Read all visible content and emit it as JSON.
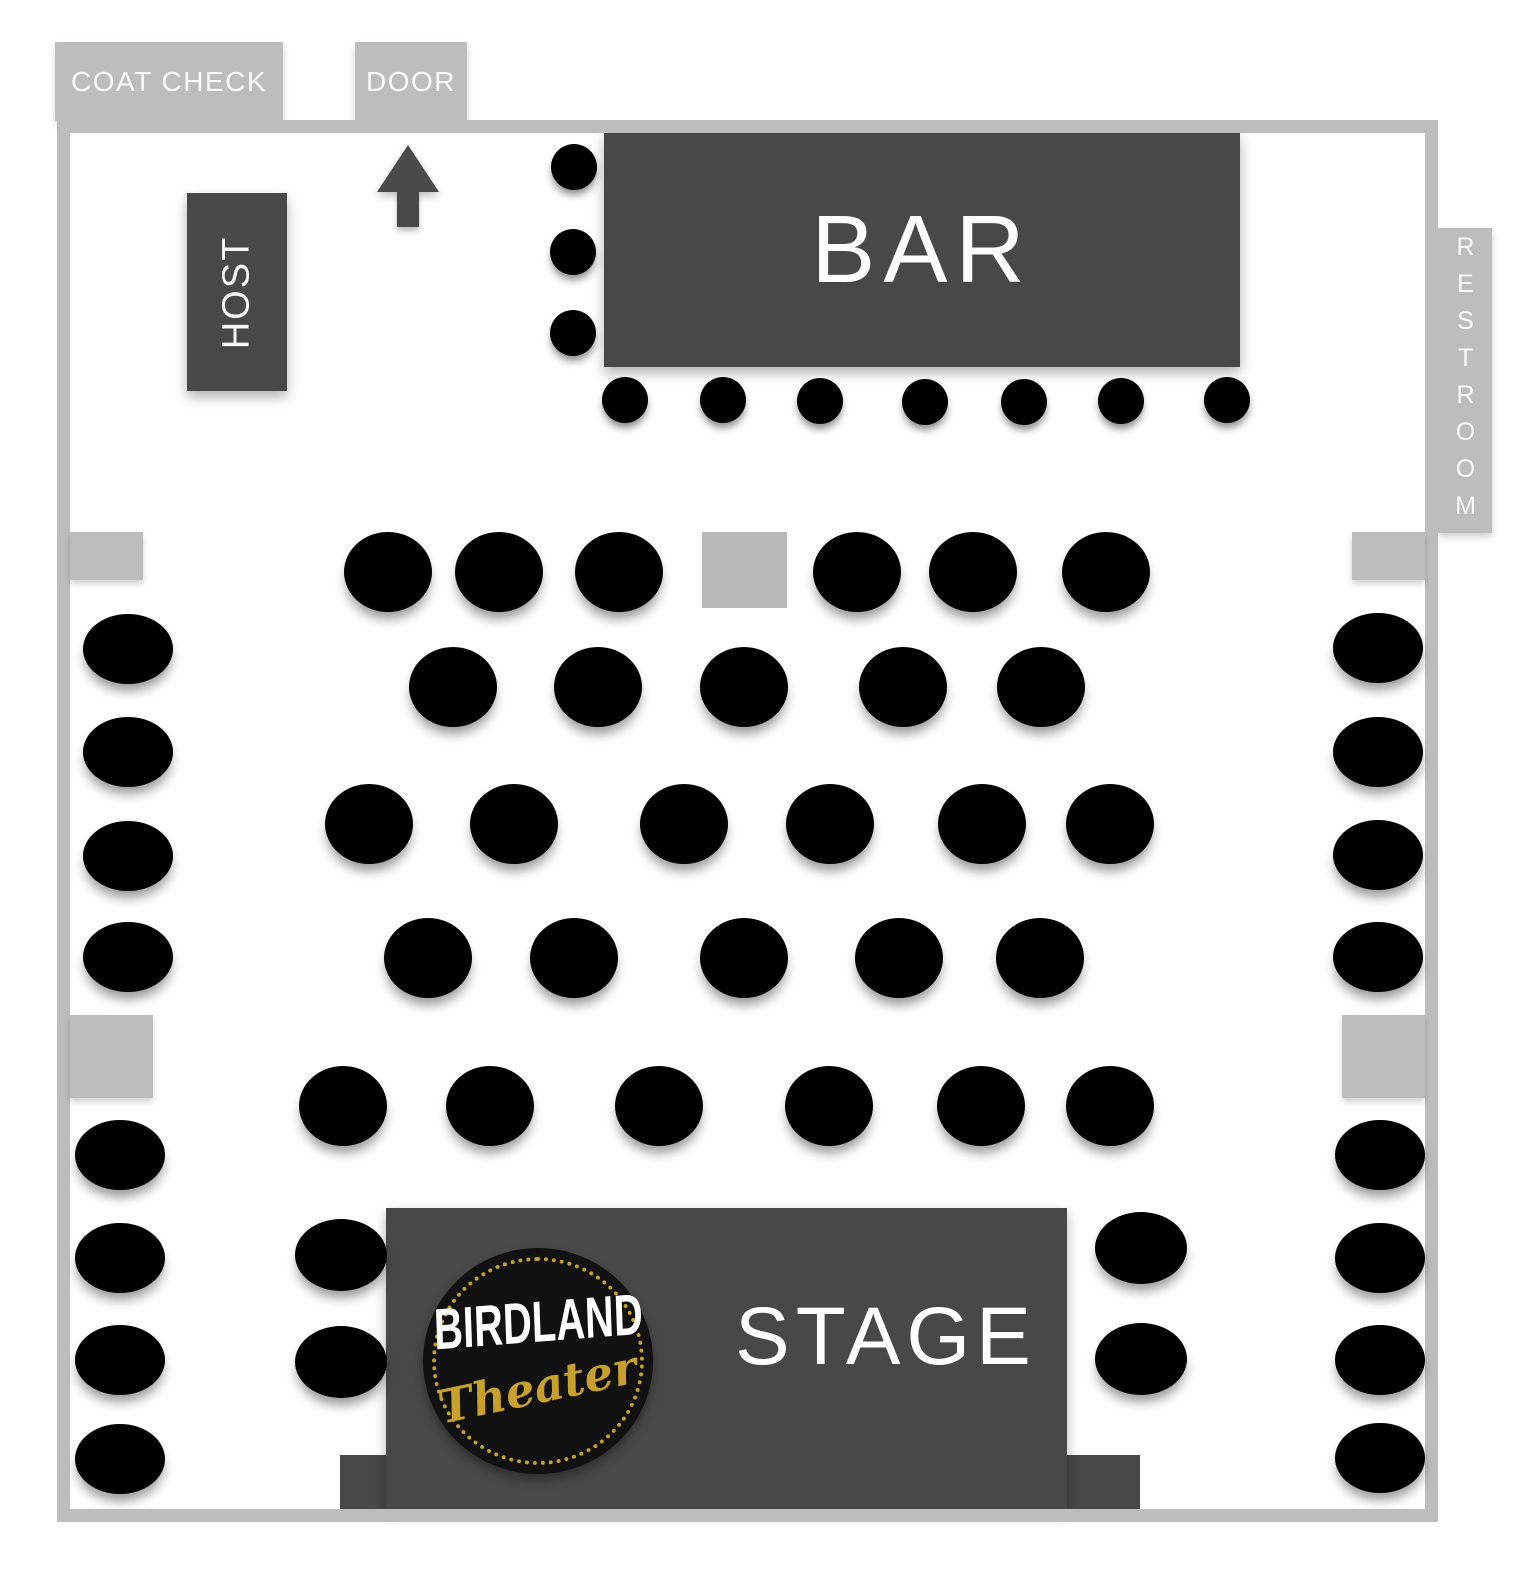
{
  "title": "Birdland Theater seating map",
  "colors": {
    "wall": "#bdbdbd",
    "dark_area": "#484848",
    "seat": "#000000",
    "label_text": "#fafafa",
    "gold": "#c8a12d",
    "booth": "#b9b9b9"
  },
  "areas": {
    "coat_check": {
      "label": "COAT CHECK",
      "x": 55,
      "y": 42,
      "w": 228,
      "h": 79
    },
    "door": {
      "label": "DOOR",
      "x": 355,
      "y": 42,
      "w": 112,
      "h": 79
    },
    "restroom": {
      "label": "RESTROOM",
      "x": 1438,
      "y": 228,
      "w": 54,
      "h": 305
    },
    "host": {
      "label": "HOST",
      "x": 187,
      "y": 193,
      "w": 100,
      "h": 198
    },
    "bar": {
      "label": "BAR",
      "x": 604,
      "y": 132,
      "w": 636,
      "h": 235
    },
    "stage": {
      "label": "STAGE",
      "x": 386,
      "y": 1208,
      "w": 681,
      "h": 301
    },
    "stage_apron": {
      "label": "",
      "x": 340,
      "y": 1455,
      "w": 800,
      "h": 54
    }
  },
  "stage_label_pos": {
    "x": 735,
    "y": 1290,
    "w": 290
  },
  "logo": {
    "line1": "BIRDLAND",
    "line2": "Theater",
    "cx": 538,
    "cy": 1361,
    "rx": 115,
    "ry": 113
  },
  "walls": [
    {
      "side": "top",
      "x": 57,
      "y": 120,
      "w": 1381,
      "h": 13
    },
    {
      "side": "left",
      "x": 57,
      "y": 120,
      "w": 13,
      "h": 1402
    },
    {
      "side": "right",
      "x": 1425,
      "y": 120,
      "w": 13,
      "h": 1402
    },
    {
      "side": "bottom",
      "x": 57,
      "y": 1509,
      "w": 1381,
      "h": 13
    }
  ],
  "pillars": [
    {
      "x": 70,
      "y": 532,
      "w": 73,
      "h": 48
    },
    {
      "x": 1352,
      "y": 532,
      "w": 73,
      "h": 48
    },
    {
      "x": 70,
      "y": 1015,
      "w": 83,
      "h": 83
    },
    {
      "x": 1342,
      "y": 1015,
      "w": 83,
      "h": 83
    }
  ],
  "booth": {
    "x": 702,
    "y": 532,
    "w": 85,
    "h": 76
  },
  "entry_arrow": {
    "x": 377,
    "y": 145,
    "w": 62,
    "h": 82,
    "direction": "up"
  },
  "seats": {
    "table_groups": [
      {
        "name": "row-a",
        "rx": 44,
        "ry": 40,
        "pts": [
          [
            388,
            572
          ],
          [
            499,
            572
          ],
          [
            619,
            572
          ],
          [
            857,
            572
          ],
          [
            973,
            572
          ],
          [
            1106,
            572
          ]
        ]
      },
      {
        "name": "row-b",
        "rx": 44,
        "ry": 40,
        "pts": [
          [
            453,
            687
          ],
          [
            598,
            687
          ],
          [
            744,
            687
          ],
          [
            903,
            687
          ],
          [
            1041,
            687
          ]
        ]
      },
      {
        "name": "row-c",
        "rx": 44,
        "ry": 40,
        "pts": [
          [
            369,
            824
          ],
          [
            514,
            824
          ],
          [
            684,
            824
          ],
          [
            830,
            824
          ],
          [
            982,
            824
          ],
          [
            1110,
            824
          ]
        ]
      },
      {
        "name": "row-d",
        "rx": 44,
        "ry": 40,
        "pts": [
          [
            428,
            958
          ],
          [
            574,
            958
          ],
          [
            744,
            958
          ],
          [
            899,
            958
          ],
          [
            1040,
            958
          ]
        ]
      },
      {
        "name": "row-e",
        "rx": 44,
        "ry": 40,
        "pts": [
          [
            343,
            1106
          ],
          [
            490,
            1106
          ],
          [
            659,
            1106
          ],
          [
            829,
            1106
          ],
          [
            981,
            1106
          ],
          [
            1110,
            1106
          ]
        ]
      },
      {
        "name": "left-wall-upper",
        "rx": 45,
        "ry": 35,
        "pts": [
          [
            128,
            649
          ],
          [
            128,
            752
          ],
          [
            128,
            856
          ],
          [
            128,
            957
          ]
        ]
      },
      {
        "name": "right-wall-upper",
        "rx": 45,
        "ry": 35,
        "pts": [
          [
            1378,
            648
          ],
          [
            1378,
            752
          ],
          [
            1378,
            855
          ],
          [
            1378,
            957
          ]
        ]
      },
      {
        "name": "left-wall-lower",
        "rx": 45,
        "ry": 35,
        "pts": [
          [
            120,
            1155
          ],
          [
            120,
            1258
          ],
          [
            120,
            1360
          ],
          [
            120,
            1459
          ]
        ]
      },
      {
        "name": "right-wall-lower",
        "rx": 45,
        "ry": 35,
        "pts": [
          [
            1380,
            1155
          ],
          [
            1380,
            1258
          ],
          [
            1380,
            1360
          ],
          [
            1380,
            1458
          ]
        ]
      },
      {
        "name": "stage-left",
        "rx": 46,
        "ry": 36,
        "pts": [
          [
            341,
            1255
          ],
          [
            341,
            1362
          ]
        ]
      },
      {
        "name": "stage-right",
        "rx": 46,
        "ry": 36,
        "pts": [
          [
            1141,
            1248
          ],
          [
            1141,
            1359
          ]
        ]
      }
    ],
    "stool_groups": [
      {
        "name": "bar-side-stool",
        "rx": 23,
        "ry": 23,
        "pts": [
          [
            574,
            167
          ],
          [
            573,
            252
          ],
          [
            573,
            333
          ]
        ]
      },
      {
        "name": "bar-front-stool",
        "rx": 23,
        "ry": 23,
        "pts": [
          [
            625,
            400
          ],
          [
            723,
            400
          ],
          [
            820,
            401
          ],
          [
            925,
            402
          ],
          [
            1024,
            402
          ],
          [
            1121,
            401
          ],
          [
            1227,
            400
          ]
        ]
      }
    ]
  }
}
